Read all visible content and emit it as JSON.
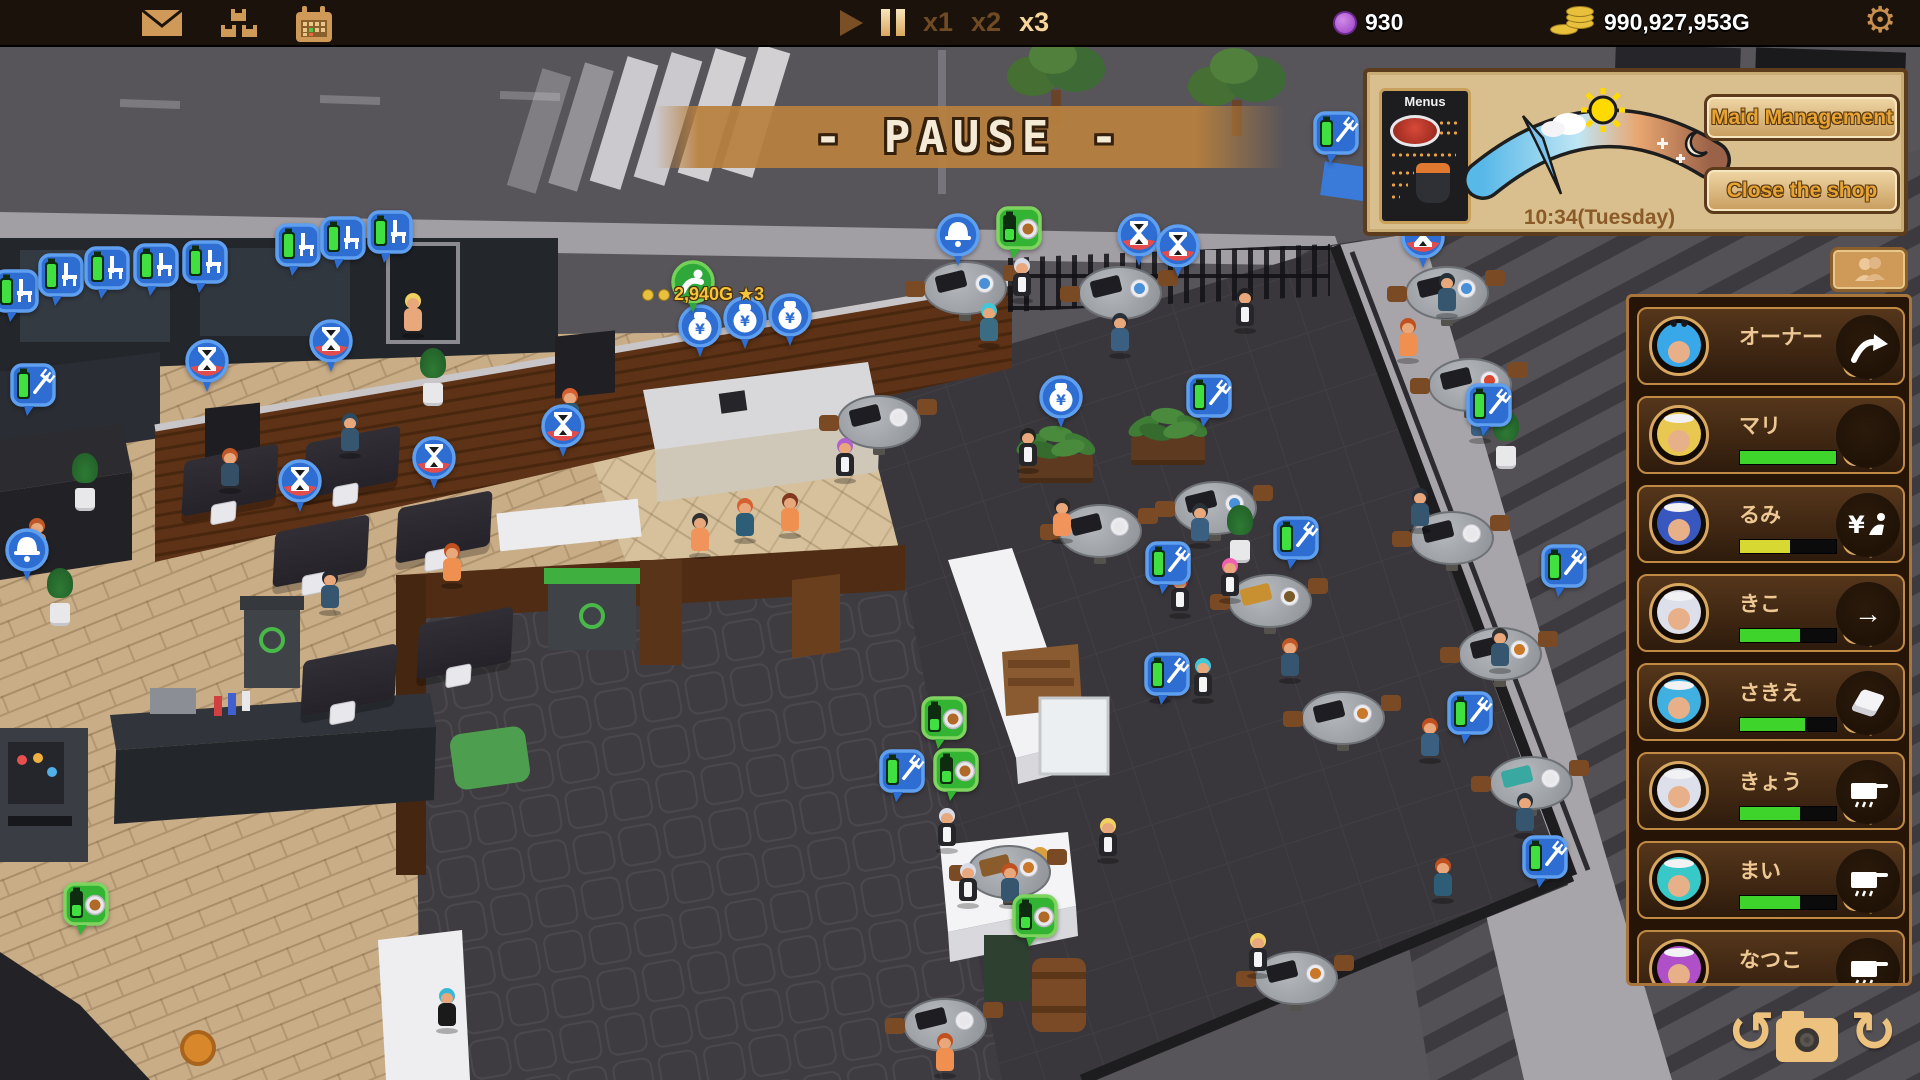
{
  "topbar": {
    "icons": [
      "mail",
      "crates",
      "calendar"
    ],
    "speeds": [
      "x1",
      "x2",
      "x3"
    ],
    "active_speed": "x3",
    "tickets": "930",
    "gold": "990,927,953G"
  },
  "pause_banner": {
    "text": "- PAUSE -"
  },
  "hud": {
    "menus_label": "Menus",
    "time": "10:34(Tuesday)",
    "maid_management_label": "Maid Management",
    "close_shop_label": "Close the shop"
  },
  "reward": {
    "text": "2,940G ★3"
  },
  "maids": [
    {
      "name": "オーナー",
      "hair": "#38a8e8",
      "ears": true,
      "action": "share"
    },
    {
      "name": "マリ",
      "hair": "#e8c850",
      "band": true,
      "bar": {
        "color": "#3fd42c",
        "pct": 100
      },
      "action": "none"
    },
    {
      "name": "るみ",
      "hair": "#3858c0",
      "band": true,
      "bar": {
        "color": "#d8d832",
        "pct": 52
      },
      "action": "yen"
    },
    {
      "name": "きこ",
      "hair": "#dde0ea",
      "band": true,
      "bar": {
        "color": "#3fd42c",
        "pct": 62
      },
      "action": "arrow"
    },
    {
      "name": "さきえ",
      "hair": "#40b0e0",
      "band": true,
      "bar": {
        "color": "#3fd42c",
        "pct": 68
      },
      "action": "napkin"
    },
    {
      "name": "きょう",
      "hair": "#dde0ea",
      "band": true,
      "bar": {
        "color": "#3fd42c",
        "pct": 62
      },
      "action": "pot"
    },
    {
      "name": "まい",
      "hair": "#38c8c8",
      "band": true,
      "bar": {
        "color": "#3fd42c",
        "pct": 62
      },
      "action": "pot"
    },
    {
      "name": "なつこ",
      "hair": "#b050c8",
      "band": true,
      "action": "pot"
    }
  ],
  "scene": {
    "pins": [
      {
        "t": "chairq",
        "x": 16,
        "y": 318
      },
      {
        "t": "chairq",
        "x": 61,
        "y": 302
      },
      {
        "t": "chairq",
        "x": 107,
        "y": 295
      },
      {
        "t": "chairq",
        "x": 156,
        "y": 292
      },
      {
        "t": "chairq",
        "x": 205,
        "y": 289
      },
      {
        "t": "chairq",
        "x": 298,
        "y": 272
      },
      {
        "t": "chairq",
        "x": 343,
        "y": 265
      },
      {
        "t": "chairq",
        "x": 390,
        "y": 259
      },
      {
        "t": "hourglass",
        "x": 207,
        "y": 387
      },
      {
        "t": "hourglass",
        "x": 331,
        "y": 367
      },
      {
        "t": "hourglass",
        "x": 300,
        "y": 507
      },
      {
        "t": "hourglass",
        "x": 434,
        "y": 484
      },
      {
        "t": "hourglass",
        "x": 563,
        "y": 452
      },
      {
        "t": "hourglass",
        "x": 1139,
        "y": 261
      },
      {
        "t": "hourglass",
        "x": 1178,
        "y": 272
      },
      {
        "t": "hourglass",
        "x": 1423,
        "y": 263
      },
      {
        "t": "batfork",
        "x": 33,
        "y": 412
      },
      {
        "t": "batfork",
        "x": 1209,
        "y": 423
      },
      {
        "t": "batfork",
        "x": 1296,
        "y": 565
      },
      {
        "t": "batfork",
        "x": 1168,
        "y": 590
      },
      {
        "t": "batfork",
        "x": 1167,
        "y": 701
      },
      {
        "t": "batfork",
        "x": 1336,
        "y": 160
      },
      {
        "t": "batfork",
        "x": 1470,
        "y": 740
      },
      {
        "t": "batfork",
        "x": 1564,
        "y": 593
      },
      {
        "t": "batfork",
        "x": 1489,
        "y": 432
      },
      {
        "t": "batfork",
        "x": 1545,
        "y": 884
      },
      {
        "t": "batfork",
        "x": 902,
        "y": 798
      },
      {
        "t": "moneybag",
        "x": 700,
        "y": 352
      },
      {
        "t": "moneybag",
        "x": 745,
        "y": 344
      },
      {
        "t": "moneybag",
        "x": 790,
        "y": 341
      },
      {
        "t": "moneybag",
        "x": 1061,
        "y": 423
      },
      {
        "t": "greenbow",
        "x": 693,
        "y": 308
      },
      {
        "t": "bell",
        "x": 958,
        "y": 261
      },
      {
        "t": "bell",
        "x": 27,
        "y": 576
      },
      {
        "t": "greenfood",
        "x": 944,
        "y": 745
      },
      {
        "t": "greenfood",
        "x": 956,
        "y": 797
      },
      {
        "t": "greenfood",
        "x": 1019,
        "y": 255
      },
      {
        "t": "greenfood",
        "x": 1035,
        "y": 943
      },
      {
        "t": "greenfood",
        "x": 86,
        "y": 931
      }
    ],
    "characters": [
      {
        "x": 413,
        "y": 335,
        "hair": "#f0d060",
        "outfit": "#e8a87c"
      },
      {
        "x": 570,
        "y": 430,
        "hair": "#d86030",
        "outfit": "#2e5d78"
      },
      {
        "x": 700,
        "y": 555,
        "hair": "#303030",
        "outfit": "#f0945c"
      },
      {
        "x": 745,
        "y": 540,
        "hair": "#d86030",
        "outfit": "#2e5d78"
      },
      {
        "x": 790,
        "y": 535,
        "hair": "#803820",
        "outfit": "#f09050"
      },
      {
        "x": 845,
        "y": 480,
        "hair": "#b060d0",
        "outfit": "#26262a",
        "apron": true
      },
      {
        "x": 230,
        "y": 490,
        "hair": "#c05828",
        "outfit": "#354f66"
      },
      {
        "x": 350,
        "y": 455,
        "hair": "#2c4a60",
        "outfit": "#35566e"
      },
      {
        "x": 330,
        "y": 612,
        "hair": "#26262e",
        "outfit": "#35566e"
      },
      {
        "x": 452,
        "y": 585,
        "hair": "#c05020",
        "outfit": "#f09050"
      },
      {
        "x": 37,
        "y": 560,
        "hair": "#c05828",
        "outfit": "#f09050"
      },
      {
        "x": 989,
        "y": 345,
        "hair": "#40c8d8",
        "outfit": "#3a6d84"
      },
      {
        "x": 1022,
        "y": 300,
        "hair": "#d8dce8",
        "outfit": "#26262a",
        "apron": true
      },
      {
        "x": 1245,
        "y": 330,
        "hair": "#202020",
        "outfit": "#26262a",
        "apron": true
      },
      {
        "x": 1028,
        "y": 470,
        "hair": "#222222",
        "outfit": "#26262a",
        "apron": true
      },
      {
        "x": 1062,
        "y": 540,
        "hair": "#282828",
        "outfit": "#f0945c"
      },
      {
        "x": 1200,
        "y": 545,
        "hair": "#283038",
        "outfit": "#3a5f80"
      },
      {
        "x": 1230,
        "y": 600,
        "hair": "#f060b0",
        "outfit": "#26262a",
        "apron": true
      },
      {
        "x": 1180,
        "y": 615,
        "hair": "#e03838",
        "outfit": "#26262a",
        "apron": true
      },
      {
        "x": 1203,
        "y": 700,
        "hair": "#40c8d8",
        "outfit": "#26262a",
        "apron": true
      },
      {
        "x": 1160,
        "y": 700,
        "hair": "#c05020",
        "outfit": "#35566e"
      },
      {
        "x": 1290,
        "y": 680,
        "hair": "#c05828",
        "outfit": "#35566e"
      },
      {
        "x": 1108,
        "y": 860,
        "hair": "#f0d060",
        "outfit": "#26262a",
        "apron": true
      },
      {
        "x": 1010,
        "y": 905,
        "hair": "#c05020",
        "outfit": "#35566e"
      },
      {
        "x": 945,
        "y": 1075,
        "hair": "#c05020",
        "outfit": "#f09050"
      },
      {
        "x": 1258,
        "y": 975,
        "hair": "#f0d060",
        "outfit": "#26262a",
        "apron": true
      },
      {
        "x": 1447,
        "y": 315,
        "hair": "#26303a",
        "outfit": "#35566e"
      },
      {
        "x": 1408,
        "y": 360,
        "hair": "#c05020",
        "outfit": "#f09050"
      },
      {
        "x": 1480,
        "y": 440,
        "hair": "#303030",
        "outfit": "#3a5f80"
      },
      {
        "x": 1420,
        "y": 530,
        "hair": "#26303a",
        "outfit": "#35566e"
      },
      {
        "x": 1500,
        "y": 670,
        "hair": "#303030",
        "outfit": "#35566e"
      },
      {
        "x": 1430,
        "y": 760,
        "hair": "#c05020",
        "outfit": "#3a5f80"
      },
      {
        "x": 1525,
        "y": 835,
        "hair": "#26303a",
        "outfit": "#35566e"
      },
      {
        "x": 1443,
        "y": 900,
        "hair": "#c05020",
        "outfit": "#2e5d78"
      },
      {
        "x": 947,
        "y": 850,
        "hair": "#d8dce8",
        "outfit": "#26262a",
        "apron": true
      },
      {
        "x": 968,
        "y": 905,
        "hair": "#d8dce8",
        "outfit": "#26262a",
        "apron": true
      },
      {
        "x": 447,
        "y": 1030,
        "hair": "#38b8d8",
        "outfit": "#1a1a1a"
      },
      {
        "x": 1120,
        "y": 355,
        "hair": "#283038",
        "outfit": "#3a5f80"
      }
    ],
    "round_tables": [
      {
        "x": 965,
        "y": 295,
        "p": "#4a90d8"
      },
      {
        "x": 1120,
        "y": 300,
        "p": "#4a90d8"
      },
      {
        "x": 879,
        "y": 429,
        "p": "#e8e8ea"
      },
      {
        "x": 1100,
        "y": 538,
        "p": "#e8e8ea"
      },
      {
        "x": 1215,
        "y": 515,
        "p": "#4a90d8"
      },
      {
        "x": 1270,
        "y": 608,
        "m": "#c89030",
        "p": "#7a5a28"
      },
      {
        "x": 1343,
        "y": 725,
        "p": "#c87828"
      },
      {
        "x": 1009,
        "y": 879,
        "m": "#8a5c2c",
        "p": "#c87828"
      },
      {
        "x": 945,
        "y": 1032,
        "p": "#e8e8ea"
      },
      {
        "x": 1296,
        "y": 985,
        "p": "#c87828"
      },
      {
        "x": 1447,
        "y": 300,
        "p": "#4a90d8"
      },
      {
        "x": 1470,
        "y": 392,
        "p": "#d84830"
      },
      {
        "x": 1452,
        "y": 545,
        "p": "#e8e8ea"
      },
      {
        "x": 1500,
        "y": 661,
        "p": "#c87828"
      },
      {
        "x": 1531,
        "y": 790,
        "m": "#38a8a0",
        "p": "#e8e8ea"
      }
    ],
    "square_tables": [
      {
        "x": 230,
        "y": 480
      },
      {
        "x": 352,
        "y": 462
      },
      {
        "x": 321,
        "y": 551
      },
      {
        "x": 444,
        "y": 527
      },
      {
        "x": 349,
        "y": 680
      },
      {
        "x": 465,
        "y": 643
      }
    ],
    "planters": [
      {
        "x": 1056,
        "y": 470
      },
      {
        "x": 1168,
        "y": 452
      }
    ],
    "pots": [
      {
        "x": 433,
        "y": 400
      },
      {
        "x": 85,
        "y": 505
      },
      {
        "x": 60,
        "y": 620
      },
      {
        "x": 1240,
        "y": 557
      },
      {
        "x": 1506,
        "y": 463
      }
    ],
    "trees": [
      {
        "x": 1056,
        "y": 118
      },
      {
        "x": 1237,
        "y": 128
      },
      {
        "x": 1549,
        "y": 175
      }
    ]
  }
}
